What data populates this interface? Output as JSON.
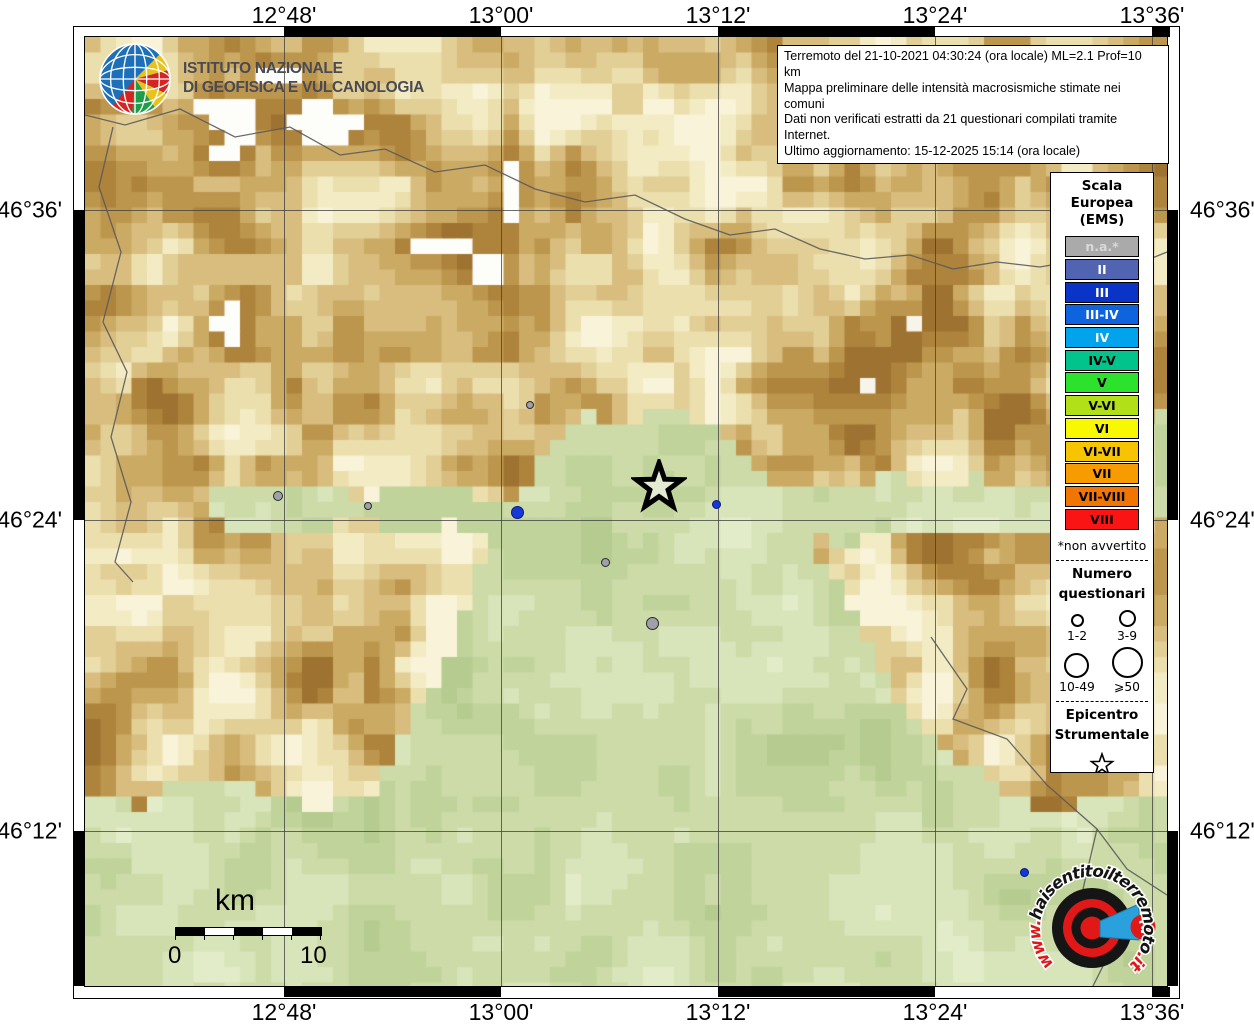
{
  "info_box": {
    "line1": "Terremoto del 21-10-2021 04:30:24 (ora locale) ML=2.1 Prof=10 km",
    "line2": "Mappa preliminare delle intensità macrosismiche stimate nei comuni",
    "line3": "Dati non verificati estratti da 21 questionari compilati tramite Internet.",
    "line4": "Ultimo aggiornamento: 15-12-2025 15:14 (ora locale)"
  },
  "ingv_logo": {
    "line1": "ISTITUTO NAZIONALE",
    "line2": "DI GEOFISICA E VULCANOLOGIA"
  },
  "axes": {
    "longitude": [
      {
        "label": "12°48'",
        "x": 284
      },
      {
        "label": "13°00'",
        "x": 501
      },
      {
        "label": "13°12'",
        "x": 718
      },
      {
        "label": "13°24'",
        "x": 935
      },
      {
        "label": "13°36'",
        "x": 1152
      }
    ],
    "latitude": [
      {
        "label": "46°36'",
        "y": 210
      },
      {
        "label": "46°24'",
        "y": 520
      },
      {
        "label": "46°12'",
        "y": 831
      }
    ]
  },
  "legend": {
    "title": "Scala\nEuropea\n(EMS)",
    "scale": [
      {
        "label": "n.a.*",
        "color": "#aaaaaa",
        "text": "#d9d9d9"
      },
      {
        "label": "II",
        "color": "#5064b2",
        "text": "#ffffff"
      },
      {
        "label": "III",
        "color": "#0a34c8",
        "text": "#ffffff"
      },
      {
        "label": "III-IV",
        "color": "#0e63de",
        "text": "#ffffff"
      },
      {
        "label": "IV",
        "color": "#00a3ec",
        "text": "#ffffff"
      },
      {
        "label": "IV-V",
        "color": "#00c48c",
        "text": "#000000"
      },
      {
        "label": "V",
        "color": "#2ce22c",
        "text": "#000000"
      },
      {
        "label": "V-VI",
        "color": "#b2e018",
        "text": "#000000"
      },
      {
        "label": "VI",
        "color": "#f8f800",
        "text": "#000000"
      },
      {
        "label": "VI-VII",
        "color": "#f6c400",
        "text": "#000000"
      },
      {
        "label": "VII",
        "color": "#f79b00",
        "text": "#000000"
      },
      {
        "label": "VII-VIII",
        "color": "#f27500",
        "text": "#000000"
      },
      {
        "label": "VIII",
        "color": "#fa1414",
        "text": "#000000"
      }
    ],
    "footnote": "*non avvertito",
    "questionnaires": {
      "title": "Numero\nquestionari",
      "sizes": [
        {
          "label": "1-2",
          "d": 9
        },
        {
          "label": "3-9",
          "d": 13
        },
        {
          "label": "10-49",
          "d": 21
        },
        {
          "label": "⩾50",
          "d": 27
        }
      ]
    },
    "epicenter_title": "Epicentro\nStrumentale"
  },
  "scale_bar": {
    "unit": "km",
    "start": "0",
    "end": "10"
  },
  "site_logo": {
    "url_prefix": "www.",
    "url_main": "haisentitoilterremoto",
    "url_suffix": ".it",
    "question_mark": "?"
  },
  "map": {
    "epicenter": {
      "x": 574,
      "y": 450
    },
    "markers": [
      {
        "x": 193,
        "y": 459,
        "d": 10,
        "type": "gray"
      },
      {
        "x": 283,
        "y": 469,
        "d": 8,
        "type": "gray"
      },
      {
        "x": 445,
        "y": 368,
        "d": 8,
        "type": "gray"
      },
      {
        "x": 432,
        "y": 475,
        "d": 13,
        "type": "blue"
      },
      {
        "x": 520,
        "y": 525,
        "d": 9,
        "type": "gray"
      },
      {
        "x": 567,
        "y": 586,
        "d": 13,
        "type": "gray"
      },
      {
        "x": 631,
        "y": 467,
        "d": 9,
        "type": "blue"
      },
      {
        "x": 939,
        "y": 835,
        "d": 9,
        "type": "blue"
      }
    ]
  },
  "colors": {
    "marker_gray": "#a0a0a8",
    "marker_blue": "#1638d8",
    "logo_red": "#e01818",
    "logo_blue": "#2aa0dc",
    "ingv_blue": "#1d70b8"
  }
}
